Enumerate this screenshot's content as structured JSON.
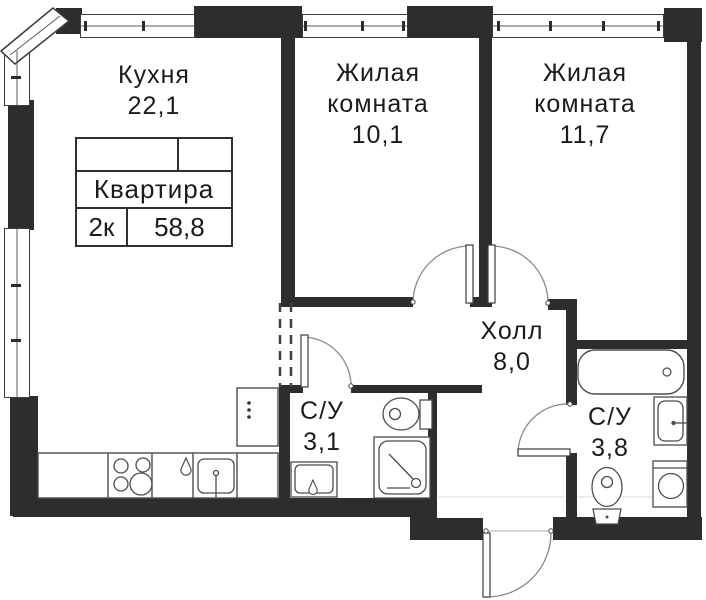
{
  "floorplan": {
    "title_block": {
      "label": "Квартира",
      "rooms_code": "2к",
      "total_area": "58,8"
    },
    "rooms": [
      {
        "name": "Кухня",
        "area": "22,1"
      },
      {
        "name": "Жилая комната",
        "area": "10,1"
      },
      {
        "name": "Жилая комната",
        "area": "11,7"
      },
      {
        "name": "Холл",
        "area": "8,0"
      },
      {
        "name": "С/У",
        "area": "3,1"
      },
      {
        "name": "С/У",
        "area": "3,8"
      }
    ],
    "fixtures": [
      "stove-icon",
      "kitchen-sink-icon",
      "faucet-icon",
      "fridge-icon",
      "shower-icon",
      "toilet-icon",
      "washbasin-icon",
      "bathtub-icon",
      "washing-machine-icon",
      "door-arc",
      "entrance-door"
    ],
    "colors": {
      "wall": "#2d2d2d",
      "line": "#4c4c4c",
      "text": "#1b1b1b"
    }
  }
}
